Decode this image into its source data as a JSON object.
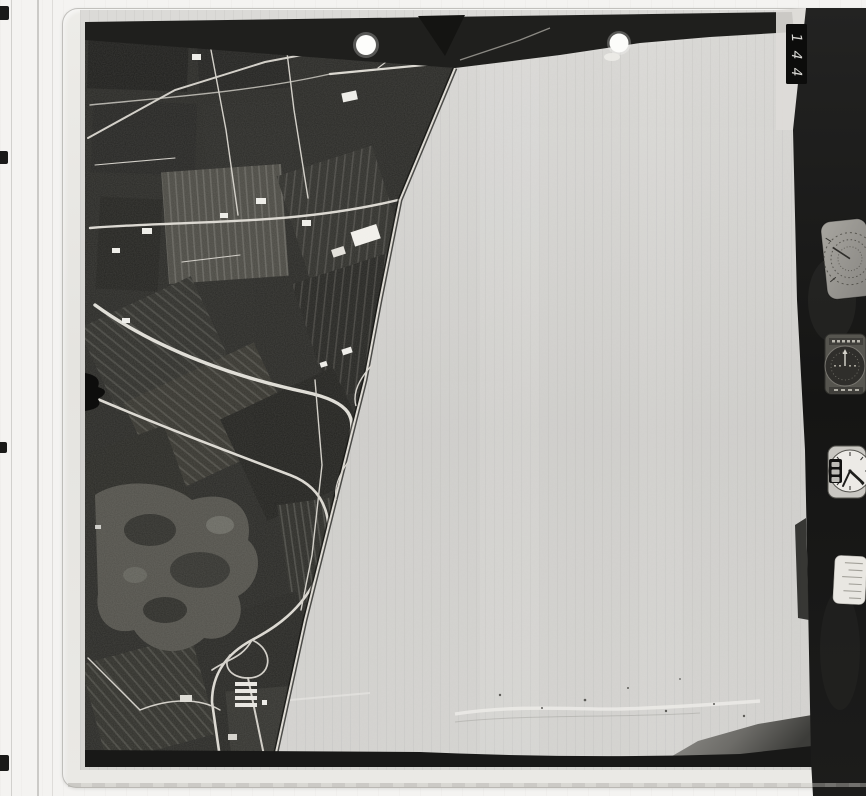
{
  "scan": {
    "frame_tab": {
      "digits": [
        "1",
        "4",
        "4"
      ]
    },
    "instruments": [
      {
        "name": "altimeter-dial"
      },
      {
        "name": "level-indicator-dial"
      },
      {
        "name": "clock-dial"
      },
      {
        "name": "data-plate"
      }
    ],
    "marks": {
      "punch_dots": 2,
      "edge_ticks": 4,
      "film_notch": 1
    },
    "colors": {
      "page_bg": "#f4f3f1",
      "sleeve": "#e8e7e3",
      "photo_blank_area": "#d4d3d0",
      "land_dark": "#292926",
      "film_band": "#1b1b1a",
      "road_light": "#d8d5ce",
      "building_white": "#efeeea"
    }
  }
}
